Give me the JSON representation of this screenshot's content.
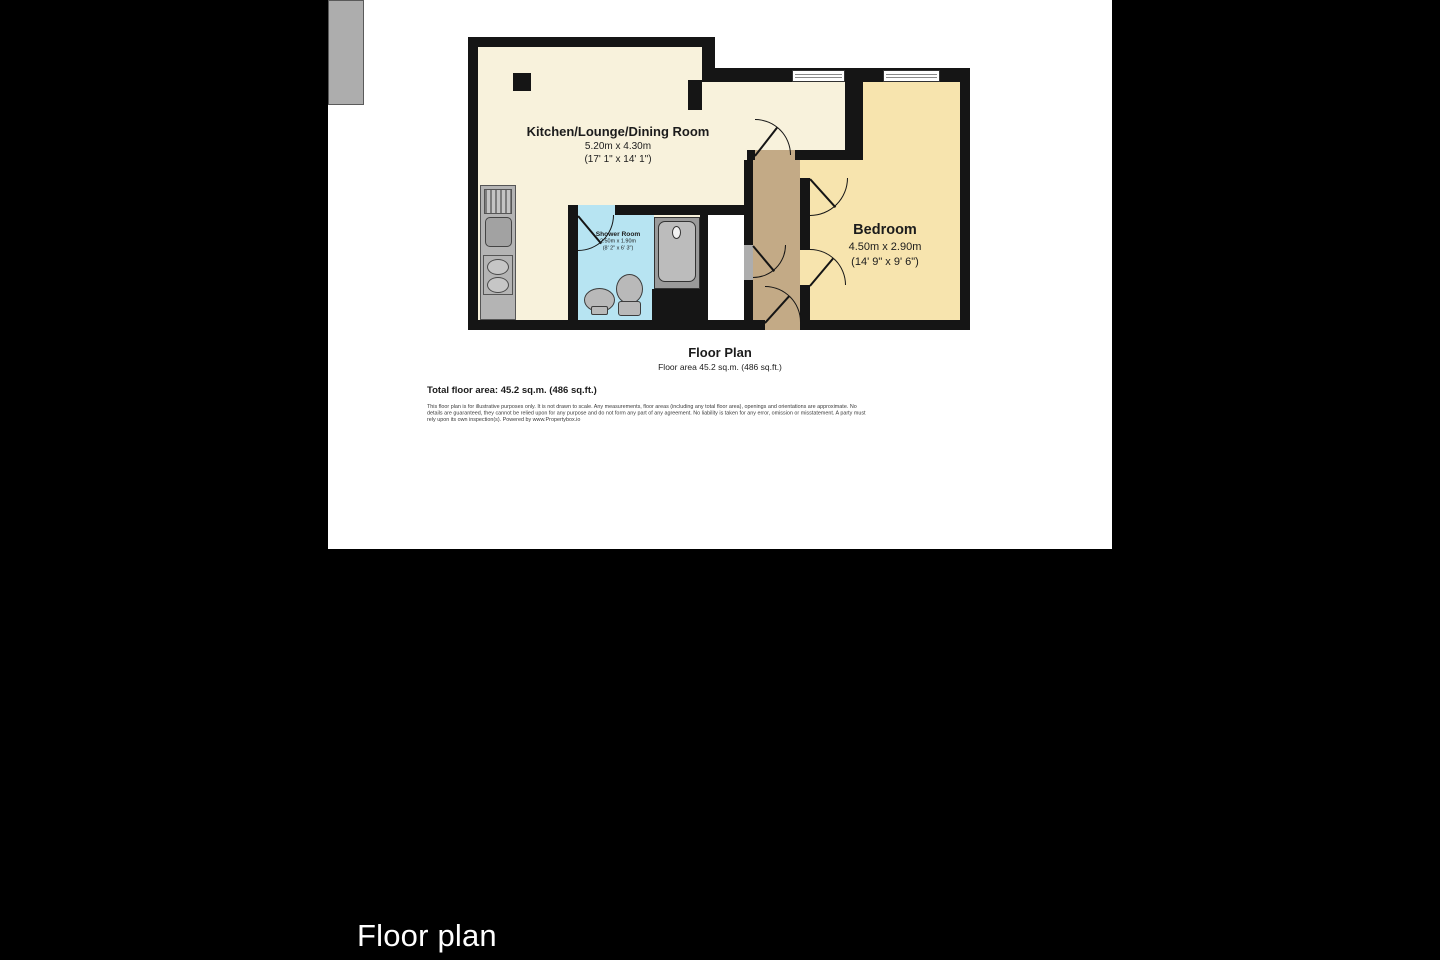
{
  "caption": "Floor plan",
  "floorplan": {
    "title": "Floor Plan",
    "subtitle": "Floor area 45.2 sq.m. (486 sq.ft.)",
    "total_area": "Total floor area: 45.2 sq.m. (486 sq.ft.)",
    "disclaimer": "This floor plan is for illustrative purposes only. It is not drawn to scale. Any measurements, floor areas (including any total floor area), openings and orientations are approximate. No details are guaranteed, they cannot be relied upon for any purpose and do not form any part of any agreement. No liability is taken for any error, omission or misstatement. A party must rely upon its own inspection(s). Powered by www.Propertybox.io",
    "rooms": [
      {
        "name": "Kitchen/Lounge/Dining Room",
        "metric": "5.20m x 4.30m",
        "imperial": "(17' 1\" x 14' 1\")"
      },
      {
        "name": "Shower Room",
        "metric": "2.50m x 1.90m",
        "imperial": "(8' 2\" x 6' 3\")"
      },
      {
        "name": "Bedroom",
        "metric": "4.50m x 2.90m",
        "imperial": "(14' 9\" x 9' 6\")"
      }
    ],
    "colors": {
      "page_background": "#000000",
      "canvas": "#ffffff",
      "wall": "#151515",
      "kitchen_floor": "#f8f2dc",
      "bedroom_floor": "#f7e4ae",
      "hallway_floor": "#c3aa86",
      "shower_room_floor": "#b7e4f2",
      "fixture_gray": "#adadad",
      "caption_text": "#ffffff"
    }
  }
}
